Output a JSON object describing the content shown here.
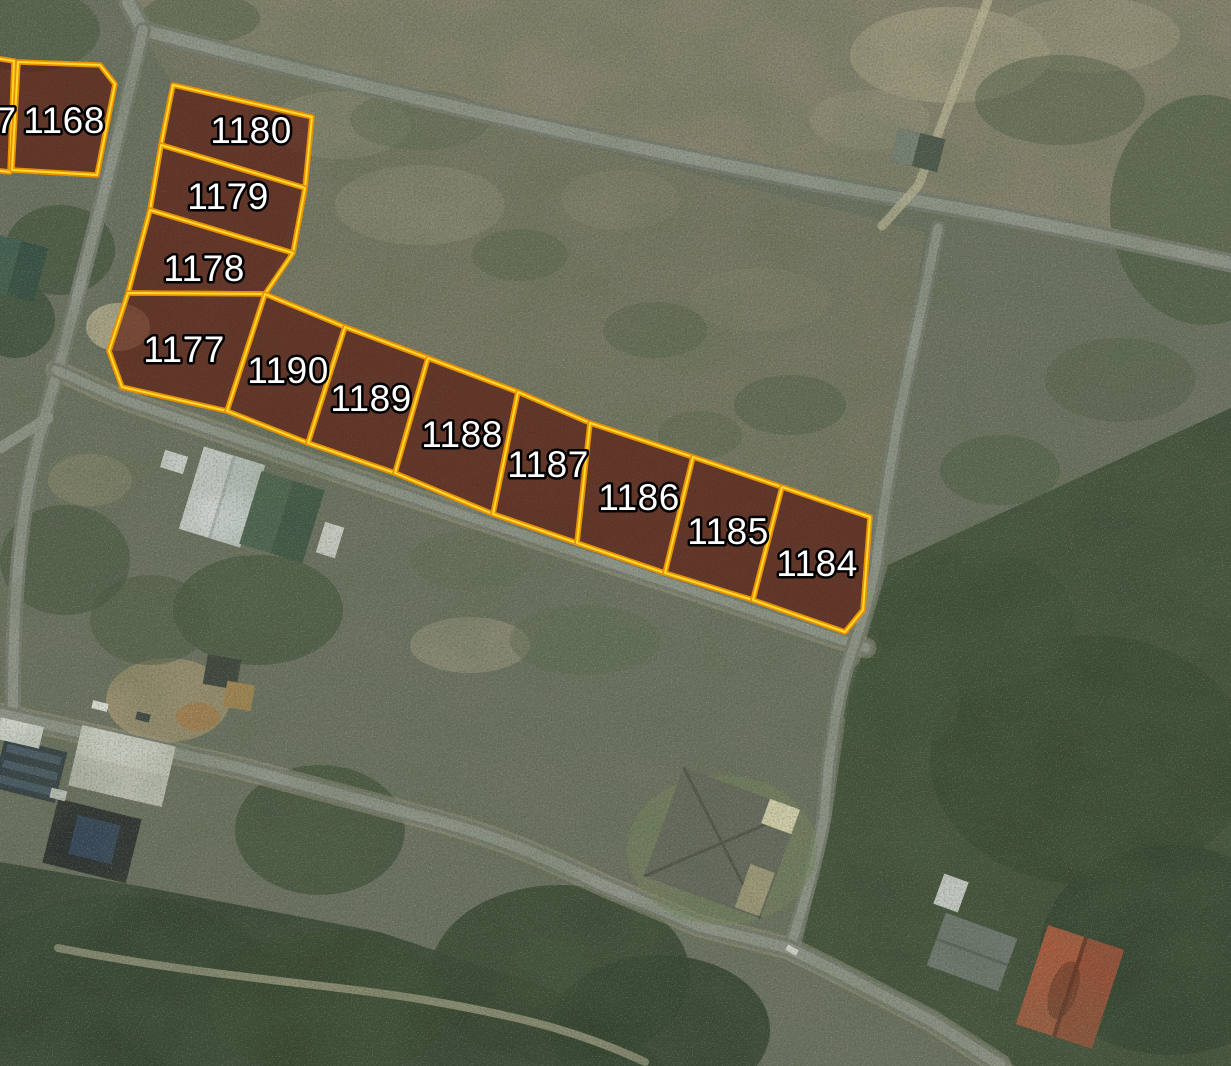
{
  "map": {
    "view": "satellite-aerial",
    "overlay": {
      "boundary_color": "#f2a400",
      "boundary_highlight_color": "#ffd92e",
      "plot_fill_color": "#5a1107",
      "label_color": "#ffffff",
      "label_outline_color": "#000000"
    },
    "plots": [
      {
        "label": "7"
      },
      {
        "label": "1168"
      },
      {
        "label": "1180"
      },
      {
        "label": "1179"
      },
      {
        "label": "1178"
      },
      {
        "label": "1177"
      },
      {
        "label": "1190"
      },
      {
        "label": "1189"
      },
      {
        "label": "1188"
      },
      {
        "label": "1187"
      },
      {
        "label": "1186"
      },
      {
        "label": "1185"
      },
      {
        "label": "1184"
      }
    ]
  }
}
